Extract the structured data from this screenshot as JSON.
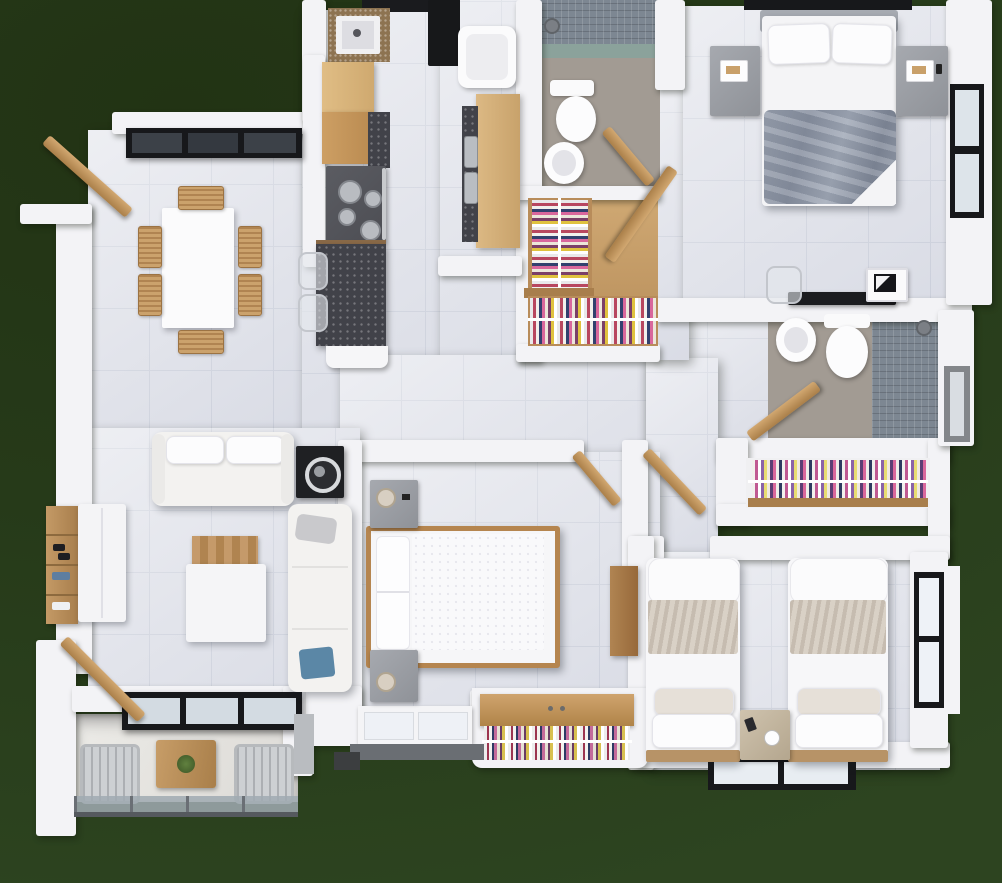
{
  "scene": {
    "type": "3d-floor-plan-render",
    "view": "top-down",
    "style": "photorealistic architectural render on dark green backdrop",
    "visible_text": "none"
  },
  "colors": {
    "bg1": "#223314",
    "bg2": "#263a19",
    "wall": "#f3f3f6",
    "floor": "#dfe1e9",
    "floorline": "#cdd1dc",
    "bath": "#a29b93",
    "mosaic": "#7d8792",
    "mosaic-accent": "#8ba29b",
    "wood": "#c49a66",
    "wood-dark": "#a87e4c",
    "granite": "#414249",
    "granite-brown": "#8d7351",
    "black": "#17181b",
    "duvet": "#8e96a5",
    "beige": "#d9d1c6",
    "glass": "#dde4ea"
  },
  "rooms": [
    {
      "name": "dining-room",
      "furniture": [
        "dining-table",
        "dining-chair x6",
        "black-frame-window",
        "open-wood-door"
      ]
    },
    {
      "name": "kitchen",
      "furniture": [
        "refrigerator",
        "sink-counter",
        "wood-cabinets",
        "gas-stove-4-burners",
        "granite-breakfast-bar",
        "bar-stool x2"
      ]
    },
    {
      "name": "laundry-utility",
      "furniture": [
        "washing-machine",
        "wood-counter",
        "double-steel-sink"
      ]
    },
    {
      "name": "bathroom-1",
      "furniture": [
        "shower-mosaic-zone",
        "shower-head",
        "toilet",
        "bidet",
        "open-wood-door"
      ]
    },
    {
      "name": "walk-in-closet-1",
      "furniture": [
        "hanging-clothes-rack x2",
        "wood-shelf"
      ]
    },
    {
      "name": "master-bedroom",
      "furniture": [
        "double-bed-gray-duvet",
        "pillow x2",
        "nightstand-lamp x2",
        "desk",
        "ghost-chair",
        "monitor",
        "east-window",
        "top-window",
        "open-wood-door"
      ]
    },
    {
      "name": "bathroom-2-ensuite",
      "furniture": [
        "toilet",
        "bidet",
        "shower-mosaic-zone",
        "shower-head",
        "side-window",
        "open-wood-door"
      ]
    },
    {
      "name": "walk-in-closet-2",
      "furniture": [
        "hanging-clothes-rail",
        "wood-shelf"
      ]
    },
    {
      "name": "bedroom-2",
      "furniture": [
        "double-bed-white",
        "nightstand-lamp x2",
        "wardrobe-hanging-clothes",
        "bay-window",
        "wood-shelf",
        "open-wood-door"
      ]
    },
    {
      "name": "bedroom-3-twin",
      "furniture": [
        "single-bed x2",
        "shared-nightstand",
        "south-window",
        "east-window"
      ]
    },
    {
      "name": "living-room",
      "furniture": [
        "two-seat-sofa",
        "chaise-sofa",
        "coffee-table-wood-tray",
        "media-speaker-unit",
        "shoe-rack",
        "sideboard",
        "sliding-glass-door"
      ]
    },
    {
      "name": "balcony",
      "furniture": [
        "lounge-chair x2",
        "wood-table-with-plant",
        "glass-railing"
      ]
    }
  ]
}
